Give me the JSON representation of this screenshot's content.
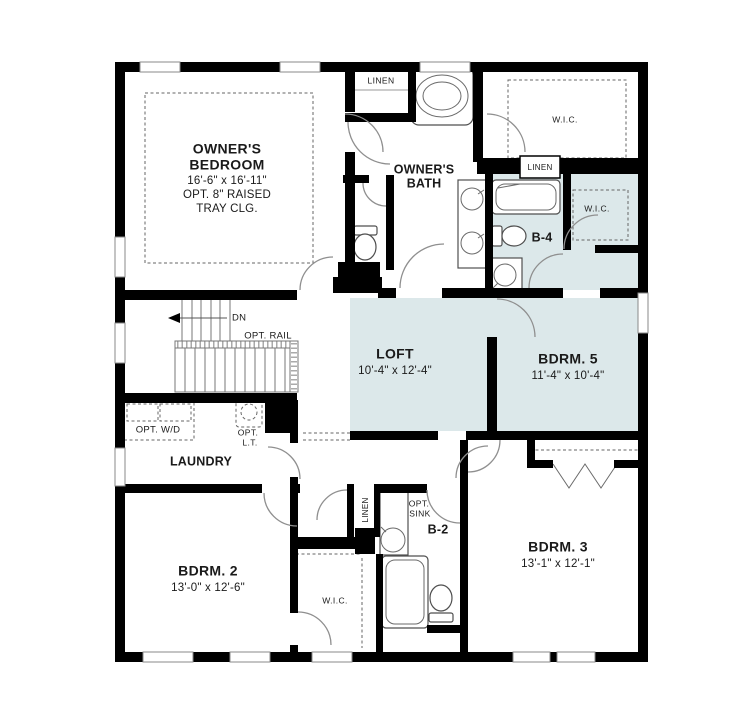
{
  "plan": {
    "colors": {
      "wall": "#000000",
      "highlight": "#dce8ea",
      "line": "#555555"
    },
    "rooms": {
      "owners_bedroom": {
        "title_line1": "OWNER'S",
        "title_line2": "BEDROOM",
        "dims": "16'-6\" x 16'-11\"",
        "note_line1": "OPT. 8\" RAISED",
        "note_line2": "TRAY CLG."
      },
      "owners_bath": {
        "title_line1": "OWNER'S",
        "title_line2": "BATH"
      },
      "loft": {
        "title": "LOFT",
        "dims": "10'-4\" x 12'-4\""
      },
      "bdrm5": {
        "title": "BDRM. 5",
        "dims": "11'-4\" x 10'-4\""
      },
      "bdrm2": {
        "title": "BDRM. 2",
        "dims": "13'-0\" x 12'-6\""
      },
      "bdrm3": {
        "title": "BDRM. 3",
        "dims": "13'-1\" x 12'-1\""
      },
      "laundry": {
        "title": "LAUNDRY"
      },
      "b4": {
        "title": "B-4"
      },
      "b2": {
        "title": "B-2"
      }
    },
    "closets": {
      "linen_top": "LINEN",
      "linen_mid": "LINEN",
      "linen_lower": "LINEN",
      "wic_owners": "W.I.C.",
      "wic_bdrm5": "W.I.C.",
      "wic_bdrm2": "W.I.C."
    },
    "annotations": {
      "dn": "DN",
      "opt_rail": "OPT. RAIL",
      "opt_wd": "OPT. W/D",
      "opt_lt_line1": "OPT.",
      "opt_lt_line2": "L.T.",
      "opt_sink_line1": "OPT.",
      "opt_sink_line2": "SINK"
    }
  }
}
